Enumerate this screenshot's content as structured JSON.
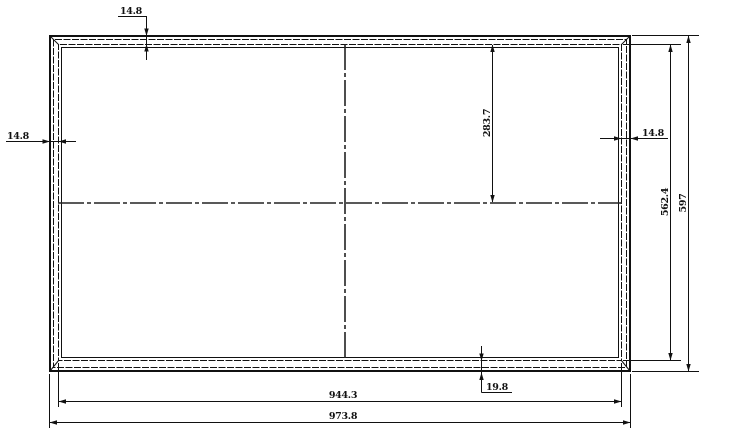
{
  "drawing": {
    "type": "cad-outline-panel",
    "colors": {
      "line": "#111111",
      "background": "#ffffff"
    },
    "dims": {
      "top_border": "14.8",
      "left_border": "14.8",
      "right_border": "14.8",
      "bottom_inset": "19.8",
      "center_offset": "283.7",
      "inner_height": "562.4",
      "outer_height": "597",
      "inner_width": "944.3",
      "outer_width": "973.8"
    }
  }
}
